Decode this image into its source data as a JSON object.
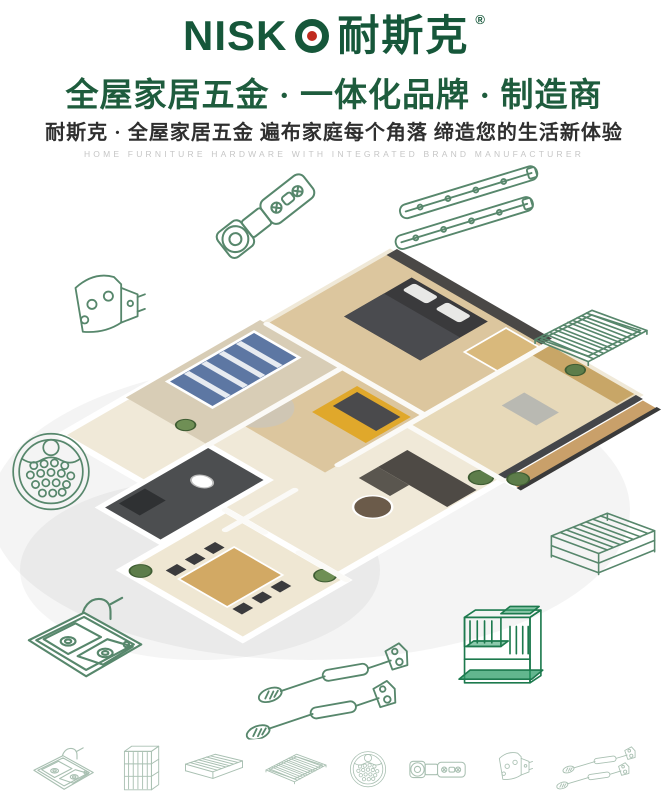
{
  "brand": {
    "logo_latin": "NISK",
    "logo_o": "O",
    "logo_cn": "耐斯克",
    "registered": "®"
  },
  "header": {
    "headline": "全屋家居五金 · 一体化品牌 · 制造商",
    "subheadline": "耐斯克 · 全屋家居五金  遍布家庭每个角落  缔造您的生活新体验",
    "tagline_en": "HOME FURNITURE HARDWARE WITH INTEGRATED BRAND MANUFACTURER"
  },
  "colors": {
    "brand_green": "#16573A",
    "headline_green": "#1E5C3D",
    "accent_red": "#C02A1E",
    "line_art_green": "#57876C",
    "line_art_faint": "#A9C0B2",
    "organizer_green": "#1D7A4E",
    "subtitle_dark": "#2F2F2F",
    "tagline_gray": "#C6C6C6"
  },
  "illustrations": {
    "center": "isometric-apartment-3d-render",
    "floating_products": [
      "concealed-hinge",
      "ball-bearing-drawer-slides",
      "corner-bracket",
      "wire-shelf-rack",
      "perforated-round-tray",
      "double-bowl-sink-with-faucet",
      "gas-lift-struts",
      "pull-out-wire-basket",
      "wire-rack-organizer"
    ],
    "bottom_products": [
      "double-bowl-sink",
      "tall-wire-basket",
      "flat-wire-basket",
      "wire-shelf-rack",
      "perforated-round-tray",
      "concealed-hinge",
      "corner-bracket",
      "gas-lift-struts"
    ]
  }
}
